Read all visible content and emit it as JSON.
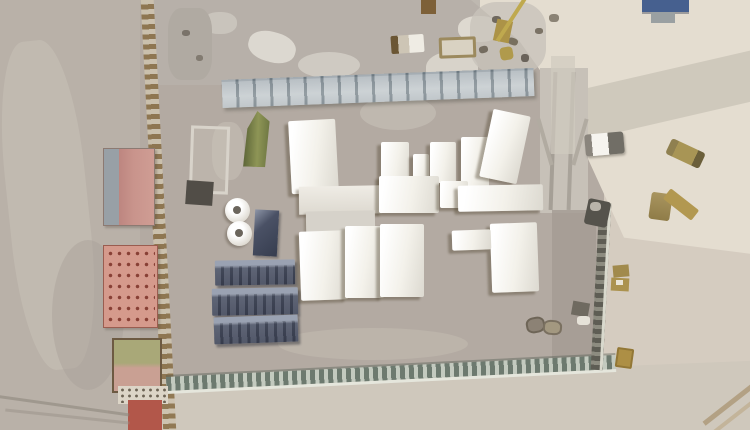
{
  "meta": {
    "type": "satellite-photo",
    "subject": "overhead satellite view of a desert construction compound with white tents, blue shipping containers, red buildings and perimeter walls",
    "width": 750,
    "height": 430
  },
  "palette": {
    "ground_outside": "#b9b1a8",
    "ground_compound": "#b3aaa2",
    "ground_right": "#d5ccc0",
    "sand_bright": "#e4ddd0",
    "tent_white": "#f3f1ea",
    "container_blue": "#4c5366",
    "building_red": "#c9948c",
    "building_salmon": "#d59a8c",
    "tent_green": "#8e9556",
    "twall_gray": "#a7b0b5",
    "wall_south_green": "#8f9a91",
    "crane_yellow": "#bfa94e",
    "panel_blue": "#46608f"
  },
  "scene": {
    "styles": {
      "tent": {
        "bg": "linear-gradient(100deg,#ffffff 10%,#f3f1ea 55%,#dcd9d0 100%)",
        "shadow": "-4px 3px 2px rgba(92,80,60,0.45)",
        "radius": "2px"
      },
      "container-blue": {
        "bg": "linear-gradient(180deg,#9aa2b2 0%,#9aa2b2 20%,#4c5366 32%,#3f4558 100%)",
        "shadow": "2px 3px 2px rgba(40,42,50,0.45)",
        "cls": "ribbed",
        "radius": "1px"
      },
      "tank": {
        "bg": "radial-gradient(circle at 40% 35%, #ffffff 30%, #dedad1 75%, #b9b4ab 100%)",
        "shadow": "-2px 2px 2px rgba(90,80,65,0.4)",
        "radius": "50%"
      }
    },
    "objects": [
      {
        "name": "terrain-base",
        "x": 0,
        "y": 0,
        "w": 750,
        "h": 430,
        "bg": "#c3bab0"
      },
      {
        "name": "terrain-left-outside",
        "x": 0,
        "y": 0,
        "w": 152,
        "h": 430,
        "bg": "#b9b1a8"
      },
      {
        "name": "terrain-left-light-band",
        "x": 8,
        "y": 40,
        "w": 80,
        "h": 330,
        "bg": "#c7bfb5",
        "radius": "40%",
        "opacity": 0.6,
        "rot": -6
      },
      {
        "name": "terrain-left-dark-patch",
        "x": 52,
        "y": 240,
        "w": 72,
        "h": 150,
        "bg": "#a8a098",
        "radius": "50%",
        "opacity": 0.45
      },
      {
        "name": "terrain-compound-ground",
        "x": 140,
        "y": 0,
        "w": 480,
        "h": 430,
        "bg": "#b3aaa2"
      },
      {
        "name": "terrain-right-outside",
        "x": 604,
        "y": 0,
        "w": 146,
        "h": 430,
        "bg": "#d5ccc0"
      },
      {
        "name": "terrain-topright-sand",
        "x": 450,
        "y": 0,
        "w": 300,
        "h": 270,
        "bg": "#e4ddd0",
        "clip": "polygon(7% 0%, 100% 0%, 100% 94%, 58% 88%, 37% 37%, 23% 15%)"
      },
      {
        "name": "diagonal-road",
        "x": 555,
        "y": 72,
        "w": 210,
        "h": 50,
        "bg": "#cdc7bb",
        "rot": -13,
        "opacity": 0.95
      },
      {
        "name": "vertical-track-road",
        "x": 540,
        "y": 68,
        "w": 48,
        "h": 145,
        "bg": "#c7c1b8"
      },
      {
        "name": "track-line-left",
        "x": 551,
        "y": 72,
        "w": 4,
        "h": 138,
        "bg": "#a59f96",
        "rot": 2
      },
      {
        "name": "track-line-right",
        "x": 569,
        "y": 72,
        "w": 4,
        "h": 138,
        "bg": "#a9a39a",
        "rot": 2
      },
      {
        "name": "rubble-zone",
        "x": 150,
        "y": 0,
        "w": 330,
        "h": 85,
        "bg": "#b7b1aa",
        "opacity": 0.85
      },
      {
        "name": "rubble-patch-1",
        "x": 203,
        "y": 12,
        "w": 34,
        "h": 22,
        "bg": "#c9c4bc",
        "radius": "45%"
      },
      {
        "name": "rubble-patch-2",
        "x": 248,
        "y": 32,
        "w": 48,
        "h": 30,
        "bg": "#dcd8d0",
        "radius": "45%",
        "rot": 15
      },
      {
        "name": "rubble-patch-3",
        "x": 298,
        "y": 52,
        "w": 62,
        "h": 26,
        "bg": "#cfcac2",
        "radius": "50%"
      },
      {
        "name": "rubble-patch-4",
        "x": 426,
        "y": 52,
        "w": 52,
        "h": 34,
        "bg": "#d8d3ca",
        "radius": "45%"
      },
      {
        "name": "rubble-patch-5",
        "x": 458,
        "y": 16,
        "w": 42,
        "h": 26,
        "bg": "#ded9d0",
        "radius": "45%"
      },
      {
        "name": "rubble-patch-6",
        "x": 470,
        "y": 2,
        "w": 76,
        "h": 72,
        "bg": "#c8c3ba",
        "radius": "35%",
        "opacity": 0.8
      },
      {
        "name": "rubble-patch-7",
        "x": 168,
        "y": 8,
        "w": 44,
        "h": 72,
        "bg": "#b0aaa2",
        "radius": "30%"
      },
      {
        "name": "rubble-patch-8",
        "x": 212,
        "y": 122,
        "w": 32,
        "h": 58,
        "bg": "#c0b9b0",
        "radius": "40%",
        "opacity": 0.8
      },
      {
        "name": "debris-speck-1",
        "x": 492,
        "y": 16,
        "w": 9,
        "h": 7,
        "bg": "#6f685e",
        "radius": "40%"
      },
      {
        "name": "debris-speck-2",
        "x": 508,
        "y": 38,
        "w": 10,
        "h": 7,
        "bg": "#78705f",
        "radius": "40%",
        "rot": 20
      },
      {
        "name": "debris-speck-3",
        "x": 521,
        "y": 54,
        "w": 8,
        "h": 8,
        "bg": "#6a635a",
        "radius": "40%"
      },
      {
        "name": "debris-speck-4",
        "x": 535,
        "y": 28,
        "w": 8,
        "h": 6,
        "bg": "#7b7366",
        "radius": "40%"
      },
      {
        "name": "debris-speck-5",
        "x": 479,
        "y": 46,
        "w": 9,
        "h": 7,
        "bg": "#746c5f",
        "radius": "40%",
        "rot": -15
      },
      {
        "name": "debris-speck-6",
        "x": 549,
        "y": 14,
        "w": 10,
        "h": 8,
        "bg": "#8b8375",
        "radius": "40%"
      },
      {
        "name": "debris-speck-7",
        "x": 182,
        "y": 30,
        "w": 8,
        "h": 6,
        "bg": "#7a736a",
        "radius": "40%"
      },
      {
        "name": "debris-speck-8",
        "x": 196,
        "y": 55,
        "w": 7,
        "h": 6,
        "bg": "#827b71",
        "radius": "40%"
      },
      {
        "name": "terrain-bottom-outside",
        "x": 148,
        "y": 358,
        "w": 602,
        "h": 72,
        "bg": "#cfc8bc",
        "clip": "polygon(0% 38%, 100% 4%, 100% 100%, 0% 100%)"
      },
      {
        "name": "inner-right-gray-strip",
        "x": 552,
        "y": 210,
        "w": 44,
        "h": 158,
        "bg": "#a49c94",
        "opacity": 0.85
      },
      {
        "name": "compound-light-patch",
        "x": 278,
        "y": 328,
        "w": 190,
        "h": 32,
        "bg": "#beb6ad",
        "radius": "50%",
        "opacity": 0.8
      },
      {
        "name": "compound-track-patch",
        "x": 360,
        "y": 96,
        "w": 76,
        "h": 34,
        "bg": "#c4beb5",
        "radius": "50%",
        "opacity": 0.7
      },
      {
        "name": "tower-structure",
        "x": 551,
        "y": 56,
        "w": 24,
        "h": 98,
        "bg": "#d0cabf",
        "opacity": 0.7
      },
      {
        "name": "tower-leg-left",
        "x": 543,
        "y": 118,
        "w": 4,
        "h": 48,
        "bg": "#b1aba1",
        "rot": -16
      },
      {
        "name": "tower-leg-right",
        "x": 578,
        "y": 118,
        "w": 4,
        "h": 48,
        "bg": "#b1aba1",
        "rot": 16
      },
      {
        "name": "perimeter-wall-west",
        "x": 152,
        "y": -6,
        "w": 13,
        "h": 444,
        "rot": -3,
        "bg": "repeating-linear-gradient(180deg,#8a7048 0px,#8a7048 5px,#cdc2ae 5px,#cdc2ae 10px)",
        "opacity": 0.9
      },
      {
        "name": "twall-stack-north",
        "x": 222,
        "y": 74,
        "w": 312,
        "h": 28,
        "rot": -2.2,
        "bg": "linear-gradient(180deg,#97a1a8 0%,#b7bfc3 60%,#a6afb4 100%)",
        "shadow": "inset 0 2px 0 #7e8a92, 2px 3px 3px rgba(70,70,60,0.35)",
        "cls": "segmented"
      },
      {
        "name": "perimeter-wall-south",
        "x": 166,
        "y": 366,
        "w": 450,
        "h": 14,
        "rot": -2.8,
        "bg": "repeating-linear-gradient(90deg,#6d7a6f 0px,#6d7a6f 5px,#c3cabf 5px,#c3cabf 9px)",
        "shadow": "0 3px 0 rgba(233,235,226,0.85), 0 -2px 0 rgba(80,90,80,0.4)"
      },
      {
        "name": "perimeter-wall-east",
        "x": 595,
        "y": 203,
        "w": 12,
        "h": 167,
        "rot": 3,
        "bg": "repeating-linear-gradient(180deg,#5e5d54 0px,#5e5d54 5px,#8d8c80 5px,#8d8c80 9px)",
        "shadow": "inset -3px 0 0 #d9d9cd"
      },
      {
        "name": "trailer-outline",
        "x": 190,
        "y": 126,
        "w": 33,
        "h": 62,
        "rot": 2,
        "bg": "rgba(205,200,190,0.35)",
        "border": "3px solid #d8d3ca"
      },
      {
        "name": "dark-slab",
        "x": 186,
        "y": 181,
        "w": 27,
        "h": 24,
        "rot": 4,
        "bg": "#514d47"
      },
      {
        "name": "green-tent",
        "x": 244,
        "y": 111,
        "w": 25,
        "h": 56,
        "rot": 2,
        "bg": "linear-gradient(90deg,#5d6638,#8e9556 55%,#6f7843)",
        "clip": "polygon(50% 0%, 100% 18%, 88% 100%, 0% 100%, 12% 32%)"
      },
      {
        "name": "tent-a",
        "style": "tent",
        "x": 290,
        "y": 120,
        "w": 47,
        "h": 73,
        "rot": -3
      },
      {
        "name": "tent-b",
        "style": "tent",
        "x": 381,
        "y": 142,
        "w": 28,
        "h": 47
      },
      {
        "name": "tent-c",
        "style": "tent",
        "x": 413,
        "y": 154,
        "w": 16,
        "h": 32
      },
      {
        "name": "tent-d",
        "style": "tent",
        "x": 430,
        "y": 142,
        "w": 26,
        "h": 41
      },
      {
        "name": "tent-e",
        "style": "tent",
        "x": 461,
        "y": 137,
        "w": 28,
        "h": 51
      },
      {
        "name": "tent-f",
        "style": "tent",
        "x": 486,
        "y": 112,
        "w": 38,
        "h": 69,
        "rot": 12
      },
      {
        "name": "hall-west",
        "x": 299,
        "y": 186,
        "w": 83,
        "h": 28,
        "rot": -1,
        "bg": "linear-gradient(180deg,#efece5,#ddd9d0)",
        "shadow": "-3px 3px 2px rgba(92,80,60,0.4)"
      },
      {
        "name": "hall-center",
        "style": "tent",
        "x": 379,
        "y": 176,
        "w": 60,
        "h": 37
      },
      {
        "name": "hall-small",
        "style": "tent",
        "x": 440,
        "y": 181,
        "w": 28,
        "h": 27
      },
      {
        "name": "hall-east",
        "style": "tent",
        "x": 458,
        "y": 185,
        "w": 85,
        "h": 26,
        "rot": -1
      },
      {
        "name": "gray-strip-building",
        "x": 306,
        "y": 211,
        "w": 69,
        "h": 21,
        "rot": -1,
        "bg": "#d6d2ca",
        "shadow": "-2px 2px 2px rgba(92,80,60,0.35)"
      },
      {
        "name": "tent-g",
        "style": "tent",
        "x": 300,
        "y": 231,
        "w": 47,
        "h": 69,
        "rot": -2
      },
      {
        "name": "tent-h",
        "style": "tent",
        "x": 345,
        "y": 226,
        "w": 39,
        "h": 72
      },
      {
        "name": "tent-i",
        "style": "tent",
        "x": 380,
        "y": 224,
        "w": 44,
        "h": 73
      },
      {
        "name": "tent-j",
        "style": "tent",
        "x": 491,
        "y": 223,
        "w": 47,
        "h": 69,
        "rot": -2
      },
      {
        "name": "white-box",
        "style": "tent",
        "x": 452,
        "y": 230,
        "w": 39,
        "h": 20,
        "rot": -2
      },
      {
        "name": "water-tank-1",
        "style": "tank",
        "x": 225,
        "y": 198,
        "w": 25,
        "h": 25
      },
      {
        "name": "water-tank-1-cap",
        "x": 233,
        "y": 206,
        "w": 8,
        "h": 8,
        "radius": "50%",
        "bg": "#6b655c"
      },
      {
        "name": "water-tank-2",
        "style": "tank",
        "x": 227,
        "y": 221,
        "w": 25,
        "h": 25
      },
      {
        "name": "water-tank-2-cap",
        "x": 235,
        "y": 229,
        "w": 8,
        "h": 8,
        "radius": "50%",
        "bg": "#6b655c"
      },
      {
        "name": "navy-container-vertical",
        "x": 254,
        "y": 210,
        "w": 24,
        "h": 46,
        "rot": 3,
        "bg": "linear-gradient(135deg,#8d95a7 0%,#4a5165 35%,#363d4f 100%)",
        "shadow": "2px 2px 2px rgba(50,50,55,0.4)"
      },
      {
        "name": "blue-container-1",
        "style": "container-blue",
        "x": 215,
        "y": 260,
        "w": 80,
        "h": 25,
        "rot": -1
      },
      {
        "name": "blue-container-2",
        "style": "container-blue",
        "x": 212,
        "y": 288,
        "w": 86,
        "h": 27,
        "rot": -1
      },
      {
        "name": "blue-container-3",
        "style": "container-blue",
        "x": 214,
        "y": 316,
        "w": 84,
        "h": 27,
        "rot": -2
      },
      {
        "name": "red-building-north",
        "x": 103,
        "y": 148,
        "w": 50,
        "h": 76,
        "bg": "linear-gradient(90deg,#98a0a6 0%,#98a0a6 30%,#bd8680 30%,#c9948c 60%,#cf9d94 100%)",
        "border": "1px solid #8c7a72",
        "shadow": "2px 2px 2px rgba(80,70,60,0.3)"
      },
      {
        "name": "red-building-south",
        "x": 103,
        "y": 245,
        "w": 53,
        "h": 81,
        "bg": "#d59a8c",
        "cls": "dotted-red",
        "border": "1px solid #9a5d50",
        "shadow": "2px 2px 2px rgba(80,70,60,0.3)"
      },
      {
        "name": "green-roof-building",
        "x": 112,
        "y": 338,
        "w": 46,
        "h": 51,
        "bg": "linear-gradient(180deg,#a9a878 0%,#a9a878 45%,#c9a093 55%,#c9a093 100%)",
        "border": "2px solid #6d5a42"
      },
      {
        "name": "white-annex-strip",
        "x": 118,
        "y": 386,
        "w": 50,
        "h": 18,
        "bg": "#dcd5c7",
        "cls": "dotted-dark"
      },
      {
        "name": "red-annex",
        "x": 128,
        "y": 400,
        "w": 34,
        "h": 30,
        "bg": "#b2574a"
      },
      {
        "name": "white-truck",
        "x": 585,
        "y": 133,
        "w": 39,
        "h": 22,
        "rot": -5,
        "radius": "3px",
        "bg": "linear-gradient(90deg,#8a857d 0%,#8a857d 18%,#f6f4ef 18%,#f6f4ef 60%,#716e66 60%)",
        "shadow": "1px 2px 2px rgba(80,75,65,0.4)"
      },
      {
        "name": "tan-vehicle",
        "x": 667,
        "y": 145,
        "w": 37,
        "h": 17,
        "rot": 25,
        "radius": "3px",
        "bg": "linear-gradient(90deg,#8f8050 0%,#8f8050 20%,#a89555 20%,#a89555 78%,#6b5f3a 78%)"
      },
      {
        "name": "excavator-body",
        "x": 650,
        "y": 193,
        "w": 21,
        "h": 27,
        "rot": 8,
        "radius": "3px",
        "bg": "linear-gradient(180deg,#a9955f,#8f7c48)"
      },
      {
        "name": "excavator-arm",
        "x": 663,
        "y": 198,
        "w": 36,
        "h": 13,
        "rot": 38,
        "radius": "2px",
        "bg": "#b29850"
      },
      {
        "name": "dark-vehicle",
        "x": 586,
        "y": 200,
        "w": 23,
        "h": 26,
        "rot": 12,
        "radius": "3px",
        "bg": "#55534c"
      },
      {
        "name": "dark-vehicle-top",
        "x": 590,
        "y": 202,
        "w": 11,
        "h": 9,
        "radius": "40%",
        "bg": "#b9b4aa"
      },
      {
        "name": "tan-box-1",
        "x": 613,
        "y": 265,
        "w": 16,
        "h": 12,
        "rot": -5,
        "bg": "#a18a4c"
      },
      {
        "name": "tan-box-2",
        "x": 611,
        "y": 278,
        "w": 18,
        "h": 13,
        "rot": 3,
        "bg": "#ab924e"
      },
      {
        "name": "tan-box-speck",
        "x": 616,
        "y": 280,
        "w": 7,
        "h": 5,
        "bg": "#e9e4d6"
      },
      {
        "name": "gold-box",
        "x": 616,
        "y": 348,
        "w": 17,
        "h": 20,
        "rot": 8,
        "radius": "2px",
        "bg": "#ad8f45",
        "shadow": "inset 0 0 0 2px rgba(120,95,40,0.5)"
      },
      {
        "name": "equipment-dark",
        "x": 572,
        "y": 302,
        "w": 17,
        "h": 14,
        "rot": 10,
        "bg": "#6f6a60"
      },
      {
        "name": "equipment-light",
        "x": 577,
        "y": 316,
        "w": 13,
        "h": 9,
        "radius": "30%",
        "bg": "#e6e2d8"
      },
      {
        "name": "compound-vehicle-1",
        "x": 526,
        "y": 317,
        "w": 15,
        "h": 12,
        "rot": -10,
        "radius": "40%",
        "bg": "#8c8275",
        "border": "2px solid #6e6557"
      },
      {
        "name": "compound-vehicle-2",
        "x": 543,
        "y": 320,
        "w": 15,
        "h": 11,
        "rot": 5,
        "radius": "40%",
        "bg": "#a39880",
        "border": "2px solid #7a7060"
      },
      {
        "name": "brown-container-top",
        "x": 421,
        "y": 0,
        "w": 15,
        "h": 14,
        "bg": "#7d6038"
      },
      {
        "name": "truck-top-1",
        "x": 391,
        "y": 35,
        "w": 33,
        "h": 18,
        "rot": -4,
        "radius": "2px",
        "bg": "linear-gradient(90deg,#6b5634 0%,#6b5634 22%,#cdc5b5 22%,#cdc5b5 55%,#efece4 55%)"
      },
      {
        "name": "truck-top-2",
        "x": 439,
        "y": 37,
        "w": 31,
        "h": 15,
        "rot": -2,
        "radius": "2px",
        "bg": "#d9d2c2",
        "border": "3px solid #9c8a5e"
      },
      {
        "name": "crane-cab",
        "x": 495,
        "y": 20,
        "w": 16,
        "h": 22,
        "rot": 12,
        "bg": "#ac9347"
      },
      {
        "name": "crane-boom",
        "x": 509,
        "y": -5,
        "w": 4,
        "h": 50,
        "rot": 33,
        "bg": "#bfa94e"
      },
      {
        "name": "crane-part",
        "x": 500,
        "y": 47,
        "w": 13,
        "h": 13,
        "rot": -10,
        "radius": "30%",
        "bg": "#b09a4c"
      },
      {
        "name": "blue-panel-topright",
        "x": 642,
        "y": 0,
        "w": 47,
        "h": 12,
        "bg": "#46608f",
        "shadow": "0 2px 0 rgba(50,60,80,0.4)"
      },
      {
        "name": "gray-box-topright",
        "x": 651,
        "y": 12,
        "w": 24,
        "h": 11,
        "bg": "#9aa0a2"
      },
      {
        "name": "road-line-bottomright-1",
        "x": 694,
        "y": 392,
        "w": 95,
        "h": 5,
        "rot": -38,
        "bg": "#b3a184"
      },
      {
        "name": "road-line-bottomright-2",
        "x": 700,
        "y": 404,
        "w": 95,
        "h": 4,
        "rot": -38,
        "bg": "#c3b49a"
      },
      {
        "name": "track-bottomleft-1",
        "x": -5,
        "y": 404,
        "w": 135,
        "h": 3,
        "rot": 8,
        "bg": "rgba(138,131,120,0.55)"
      },
      {
        "name": "track-bottomleft-2",
        "x": 5,
        "y": 415,
        "w": 125,
        "h": 3,
        "rot": 6,
        "bg": "rgba(150,143,132,0.45)"
      }
    ]
  }
}
